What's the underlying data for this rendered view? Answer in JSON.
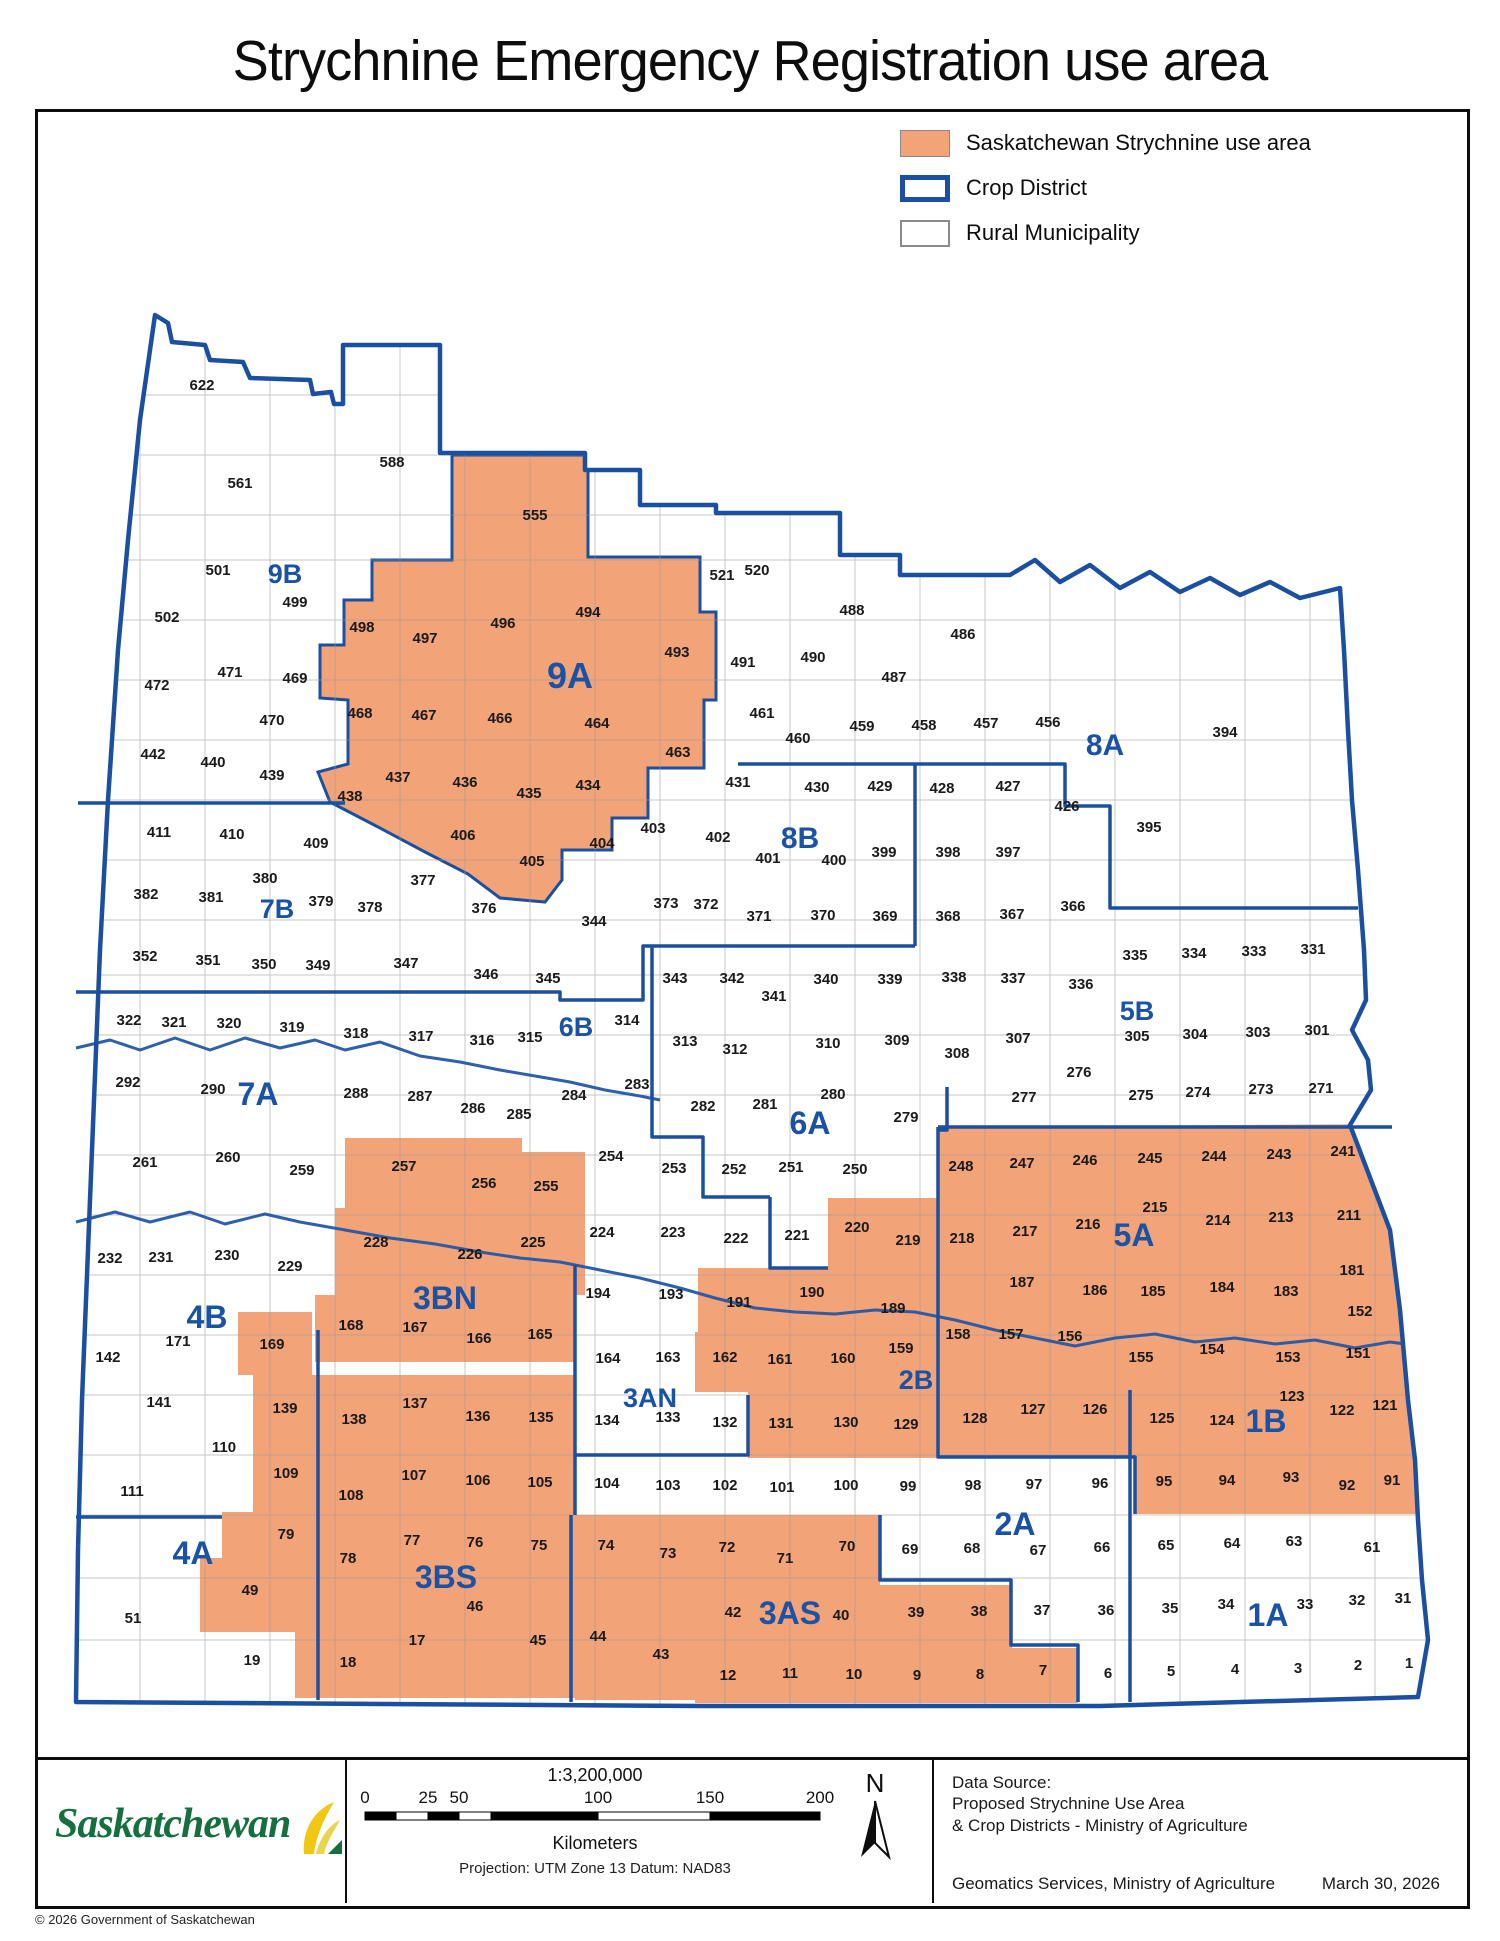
{
  "title": "Strychnine Emergency Registration use area",
  "legend": {
    "items": [
      {
        "label": "Saskatchewan Strychnine use area",
        "swatch": "use-area"
      },
      {
        "label": "Crop District",
        "swatch": "crop-district"
      },
      {
        "label": "Rural Municipality",
        "swatch": "rural-municipality"
      }
    ]
  },
  "colors": {
    "use_area": "#F2A378",
    "crop_district_line": "#1B4FA0",
    "district_label": "#1A52A5",
    "rm_border": "#9a9a9a",
    "river": "#2457A8",
    "rm_number": "#1a1a1a"
  },
  "map": {
    "districts": [
      [
        "9B",
        285,
        573,
        27
      ],
      [
        "9A",
        570,
        678,
        36
      ],
      [
        "8A",
        1105,
        745,
        30
      ],
      [
        "8B",
        800,
        838,
        30
      ],
      [
        "7B",
        277,
        908,
        27
      ],
      [
        "7A",
        258,
        1095,
        32
      ],
      [
        "6B",
        576,
        1026,
        27
      ],
      [
        "6A",
        810,
        1124,
        32
      ],
      [
        "5B",
        1137,
        1010,
        27
      ],
      [
        "5A",
        1134,
        1236,
        32
      ],
      [
        "4B",
        207,
        1318,
        32
      ],
      [
        "4A",
        193,
        1554,
        32
      ],
      [
        "3BN",
        445,
        1299,
        32
      ],
      [
        "3BS",
        446,
        1578,
        32
      ],
      [
        "3AN",
        650,
        1397,
        27
      ],
      [
        "3AS",
        790,
        1614,
        32
      ],
      [
        "2B",
        916,
        1379,
        27
      ],
      [
        "2A",
        1015,
        1525,
        32
      ],
      [
        "1B",
        1266,
        1422,
        32
      ],
      [
        "1A",
        1268,
        1616,
        32
      ]
    ],
    "rms": [
      [
        622,
        202,
        385
      ],
      [
        588,
        392,
        462
      ],
      [
        561,
        240,
        483
      ],
      [
        555,
        535,
        515
      ],
      [
        501,
        218,
        570
      ],
      [
        499,
        295,
        602
      ],
      [
        502,
        167,
        617
      ],
      [
        498,
        362,
        627
      ],
      [
        497,
        425,
        638
      ],
      [
        496,
        503,
        623
      ],
      [
        494,
        588,
        612
      ],
      [
        493,
        677,
        652
      ],
      [
        521,
        722,
        575
      ],
      [
        520,
        757,
        570
      ],
      [
        488,
        852,
        610
      ],
      [
        486,
        963,
        634
      ],
      [
        491,
        743,
        662
      ],
      [
        490,
        813,
        657
      ],
      [
        487,
        894,
        677
      ],
      [
        472,
        157,
        685
      ],
      [
        471,
        230,
        672
      ],
      [
        469,
        295,
        678
      ],
      [
        470,
        272,
        720
      ],
      [
        468,
        360,
        713
      ],
      [
        467,
        424,
        715
      ],
      [
        466,
        500,
        718
      ],
      [
        464,
        597,
        723
      ],
      [
        461,
        762,
        713
      ],
      [
        460,
        798,
        738
      ],
      [
        463,
        678,
        752
      ],
      [
        459,
        862,
        726
      ],
      [
        458,
        924,
        725
      ],
      [
        457,
        986,
        723
      ],
      [
        456,
        1048,
        722
      ],
      [
        394,
        1225,
        732
      ],
      [
        442,
        153,
        754
      ],
      [
        440,
        213,
        762
      ],
      [
        439,
        272,
        775
      ],
      [
        438,
        350,
        796
      ],
      [
        437,
        398,
        777
      ],
      [
        436,
        465,
        782
      ],
      [
        435,
        529,
        793
      ],
      [
        434,
        588,
        785
      ],
      [
        431,
        738,
        782
      ],
      [
        430,
        817,
        787
      ],
      [
        429,
        880,
        786
      ],
      [
        428,
        942,
        788
      ],
      [
        427,
        1008,
        786
      ],
      [
        426,
        1067,
        806
      ],
      [
        395,
        1149,
        827
      ],
      [
        411,
        159,
        832
      ],
      [
        410,
        232,
        834
      ],
      [
        409,
        316,
        843
      ],
      [
        406,
        463,
        835
      ],
      [
        403,
        653,
        828
      ],
      [
        402,
        718,
        837
      ],
      [
        401,
        768,
        858
      ],
      [
        400,
        834,
        860
      ],
      [
        399,
        884,
        852
      ],
      [
        398,
        948,
        852
      ],
      [
        397,
        1008,
        852
      ],
      [
        404,
        602,
        843
      ],
      [
        405,
        532,
        861
      ],
      [
        377,
        423,
        880
      ],
      [
        380,
        265,
        878
      ],
      [
        382,
        146,
        894
      ],
      [
        381,
        211,
        897
      ],
      [
        379,
        321,
        901
      ],
      [
        378,
        370,
        907
      ],
      [
        376,
        484,
        908
      ],
      [
        344,
        594,
        921
      ],
      [
        373,
        666,
        903
      ],
      [
        372,
        706,
        904
      ],
      [
        371,
        759,
        916
      ],
      [
        370,
        823,
        915
      ],
      [
        369,
        885,
        916
      ],
      [
        368,
        948,
        916
      ],
      [
        367,
        1012,
        914
      ],
      [
        366,
        1073,
        906
      ],
      [
        352,
        145,
        956
      ],
      [
        351,
        208,
        960
      ],
      [
        350,
        264,
        964
      ],
      [
        349,
        318,
        965
      ],
      [
        347,
        406,
        963
      ],
      [
        346,
        486,
        974
      ],
      [
        345,
        548,
        978
      ],
      [
        343,
        675,
        978
      ],
      [
        342,
        732,
        978
      ],
      [
        341,
        774,
        996
      ],
      [
        340,
        826,
        979
      ],
      [
        339,
        890,
        979
      ],
      [
        338,
        954,
        977
      ],
      [
        337,
        1013,
        978
      ],
      [
        336,
        1081,
        984
      ],
      [
        335,
        1135,
        955
      ],
      [
        334,
        1194,
        953
      ],
      [
        333,
        1254,
        951
      ],
      [
        331,
        1313,
        949
      ],
      [
        322,
        129,
        1020
      ],
      [
        321,
        174,
        1022
      ],
      [
        320,
        229,
        1023
      ],
      [
        319,
        292,
        1027
      ],
      [
        318,
        356,
        1033
      ],
      [
        317,
        421,
        1036
      ],
      [
        316,
        482,
        1040
      ],
      [
        315,
        530,
        1037
      ],
      [
        314,
        627,
        1020
      ],
      [
        313,
        685,
        1041
      ],
      [
        312,
        735,
        1049
      ],
      [
        310,
        828,
        1043
      ],
      [
        309,
        897,
        1040
      ],
      [
        308,
        957,
        1053
      ],
      [
        307,
        1018,
        1038
      ],
      [
        305,
        1137,
        1036
      ],
      [
        304,
        1195,
        1034
      ],
      [
        303,
        1258,
        1032
      ],
      [
        301,
        1317,
        1030
      ],
      [
        292,
        128,
        1082
      ],
      [
        290,
        213,
        1089
      ],
      [
        288,
        356,
        1093
      ],
      [
        287,
        420,
        1096
      ],
      [
        286,
        473,
        1108
      ],
      [
        285,
        519,
        1114
      ],
      [
        284,
        574,
        1095
      ],
      [
        283,
        637,
        1084
      ],
      [
        282,
        703,
        1106
      ],
      [
        281,
        765,
        1104
      ],
      [
        280,
        833,
        1094
      ],
      [
        279,
        906,
        1117
      ],
      [
        277,
        1024,
        1097
      ],
      [
        276,
        1079,
        1072
      ],
      [
        275,
        1141,
        1095
      ],
      [
        274,
        1198,
        1092
      ],
      [
        273,
        1261,
        1089
      ],
      [
        271,
        1321,
        1088
      ],
      [
        261,
        145,
        1162
      ],
      [
        260,
        228,
        1157
      ],
      [
        259,
        302,
        1170
      ],
      [
        257,
        404,
        1166
      ],
      [
        256,
        484,
        1183
      ],
      [
        255,
        546,
        1186
      ],
      [
        254,
        611,
        1156
      ],
      [
        253,
        674,
        1168
      ],
      [
        252,
        734,
        1169
      ],
      [
        251,
        791,
        1167
      ],
      [
        250,
        855,
        1169
      ],
      [
        248,
        961,
        1166
      ],
      [
        247,
        1022,
        1163
      ],
      [
        246,
        1085,
        1160
      ],
      [
        245,
        1150,
        1158
      ],
      [
        244,
        1214,
        1156
      ],
      [
        243,
        1279,
        1154
      ],
      [
        241,
        1343,
        1151
      ],
      [
        232,
        110,
        1258
      ],
      [
        231,
        161,
        1257
      ],
      [
        230,
        227,
        1255
      ],
      [
        229,
        290,
        1266
      ],
      [
        228,
        376,
        1242
      ],
      [
        226,
        470,
        1254
      ],
      [
        225,
        533,
        1242
      ],
      [
        224,
        602,
        1232
      ],
      [
        223,
        673,
        1232
      ],
      [
        222,
        736,
        1238
      ],
      [
        221,
        797,
        1235
      ],
      [
        220,
        857,
        1227
      ],
      [
        219,
        908,
        1240
      ],
      [
        218,
        962,
        1238
      ],
      [
        217,
        1025,
        1231
      ],
      [
        216,
        1088,
        1224
      ],
      [
        215,
        1155,
        1207
      ],
      [
        214,
        1218,
        1220
      ],
      [
        213,
        1281,
        1217
      ],
      [
        211,
        1349,
        1215
      ],
      [
        194,
        598,
        1293
      ],
      [
        193,
        671,
        1294
      ],
      [
        191,
        739,
        1302
      ],
      [
        190,
        812,
        1292
      ],
      [
        189,
        893,
        1308
      ],
      [
        187,
        1022,
        1282
      ],
      [
        186,
        1095,
        1290
      ],
      [
        185,
        1153,
        1291
      ],
      [
        184,
        1222,
        1287
      ],
      [
        183,
        1286,
        1291
      ],
      [
        181,
        1352,
        1270
      ],
      [
        171,
        178,
        1341
      ],
      [
        169,
        272,
        1344
      ],
      [
        168,
        351,
        1325
      ],
      [
        167,
        415,
        1327
      ],
      [
        166,
        479,
        1338
      ],
      [
        165,
        540,
        1334
      ],
      [
        164,
        608,
        1358
      ],
      [
        163,
        668,
        1357
      ],
      [
        162,
        725,
        1357
      ],
      [
        161,
        780,
        1359
      ],
      [
        160,
        843,
        1358
      ],
      [
        159,
        901,
        1348
      ],
      [
        158,
        958,
        1334
      ],
      [
        157,
        1011,
        1334
      ],
      [
        156,
        1070,
        1336
      ],
      [
        155,
        1141,
        1357
      ],
      [
        154,
        1212,
        1349
      ],
      [
        153,
        1288,
        1357
      ],
      [
        152,
        1360,
        1311
      ],
      [
        151,
        1358,
        1353
      ],
      [
        142,
        108,
        1357
      ],
      [
        141,
        159,
        1402
      ],
      [
        139,
        285,
        1408
      ],
      [
        138,
        354,
        1419
      ],
      [
        137,
        415,
        1403
      ],
      [
        136,
        478,
        1416
      ],
      [
        135,
        541,
        1417
      ],
      [
        134,
        607,
        1420
      ],
      [
        133,
        668,
        1417
      ],
      [
        132,
        725,
        1422
      ],
      [
        131,
        781,
        1423
      ],
      [
        130,
        846,
        1422
      ],
      [
        129,
        906,
        1424
      ],
      [
        128,
        975,
        1418
      ],
      [
        127,
        1033,
        1409
      ],
      [
        126,
        1095,
        1409
      ],
      [
        125,
        1162,
        1418
      ],
      [
        124,
        1222,
        1420
      ],
      [
        123,
        1292,
        1396
      ],
      [
        122,
        1342,
        1410
      ],
      [
        121,
        1385,
        1405
      ],
      [
        110,
        224,
        1447
      ],
      [
        111,
        132,
        1491
      ],
      [
        109,
        286,
        1473
      ],
      [
        108,
        351,
        1495
      ],
      [
        107,
        414,
        1475
      ],
      [
        106,
        478,
        1480
      ],
      [
        105,
        540,
        1482
      ],
      [
        104,
        607,
        1483
      ],
      [
        103,
        668,
        1485
      ],
      [
        102,
        725,
        1485
      ],
      [
        101,
        782,
        1487
      ],
      [
        100,
        846,
        1485
      ],
      [
        99,
        908,
        1486
      ],
      [
        98,
        973,
        1485
      ],
      [
        97,
        1034,
        1484
      ],
      [
        96,
        1100,
        1483
      ],
      [
        95,
        1164,
        1481
      ],
      [
        94,
        1227,
        1480
      ],
      [
        93,
        1291,
        1477
      ],
      [
        92,
        1347,
        1485
      ],
      [
        91,
        1392,
        1480
      ],
      [
        79,
        286,
        1534
      ],
      [
        78,
        348,
        1558
      ],
      [
        77,
        412,
        1540
      ],
      [
        76,
        475,
        1542
      ],
      [
        75,
        539,
        1545
      ],
      [
        74,
        606,
        1545
      ],
      [
        73,
        668,
        1553
      ],
      [
        72,
        727,
        1547
      ],
      [
        71,
        785,
        1558
      ],
      [
        70,
        847,
        1546
      ],
      [
        69,
        910,
        1549
      ],
      [
        68,
        972,
        1548
      ],
      [
        67,
        1038,
        1550
      ],
      [
        66,
        1102,
        1547
      ],
      [
        65,
        1166,
        1545
      ],
      [
        64,
        1232,
        1543
      ],
      [
        63,
        1294,
        1541
      ],
      [
        61,
        1372,
        1547
      ],
      [
        51,
        133,
        1618
      ],
      [
        49,
        250,
        1590
      ],
      [
        46,
        475,
        1606
      ],
      [
        45,
        538,
        1640
      ],
      [
        44,
        598,
        1636
      ],
      [
        43,
        661,
        1654
      ],
      [
        42,
        733,
        1612
      ],
      [
        40,
        841,
        1615
      ],
      [
        39,
        916,
        1612
      ],
      [
        38,
        979,
        1611
      ],
      [
        37,
        1042,
        1610
      ],
      [
        36,
        1106,
        1610
      ],
      [
        35,
        1170,
        1608
      ],
      [
        34,
        1226,
        1604
      ],
      [
        33,
        1305,
        1604
      ],
      [
        32,
        1357,
        1600
      ],
      [
        31,
        1403,
        1598
      ],
      [
        19,
        252,
        1660
      ],
      [
        18,
        348,
        1662
      ],
      [
        17,
        417,
        1640
      ],
      [
        12,
        728,
        1675
      ],
      [
        11,
        790,
        1673
      ],
      [
        10,
        854,
        1674
      ],
      [
        9,
        917,
        1675
      ],
      [
        8,
        980,
        1674
      ],
      [
        7,
        1043,
        1670
      ],
      [
        6,
        1108,
        1673
      ],
      [
        5,
        1171,
        1671
      ],
      [
        4,
        1235,
        1669
      ],
      [
        3,
        1298,
        1668
      ],
      [
        2,
        1358,
        1665
      ],
      [
        1,
        1409,
        1663
      ]
    ]
  },
  "footer": {
    "logo_text": "Saskatchewan",
    "north_label": "N",
    "scale": {
      "ratio": "1:3,200,000",
      "ticks": [
        "0",
        "25",
        "50",
        "100",
        "150",
        "200"
      ],
      "unit_label": "Kilometers",
      "projection": "Projection: UTM Zone 13   Datum: NAD83"
    },
    "data_source_lines": [
      "Data Source:",
      "Proposed Strychnine Use Area",
      "& Crop Districts - Ministry of Agriculture"
    ],
    "credit": "Geomatics Services, Ministry of Agriculture",
    "date": "March 30, 2026"
  },
  "copyright": "© 2026 Government of Saskatchewan"
}
